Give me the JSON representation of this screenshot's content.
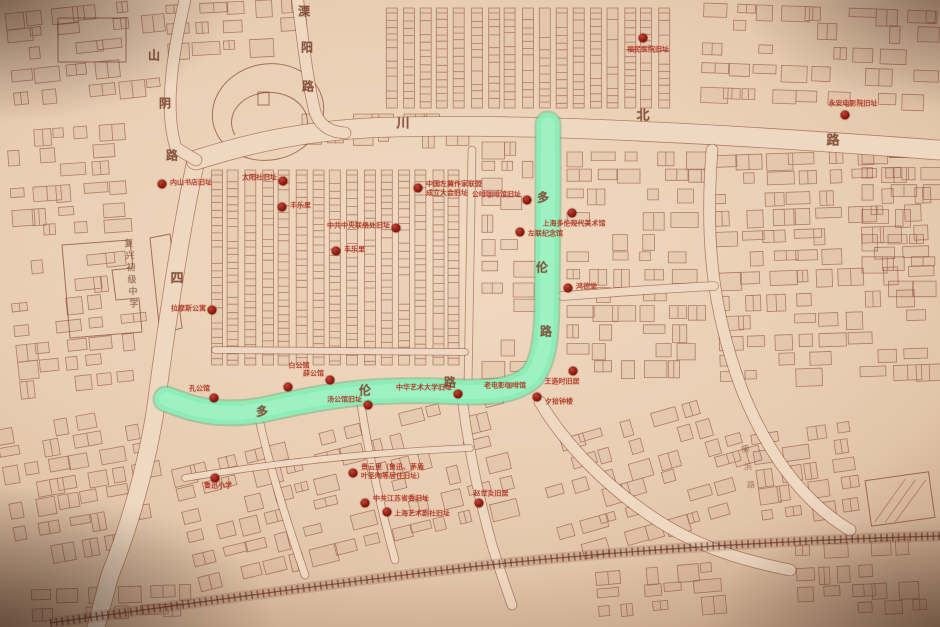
{
  "map": {
    "colors": {
      "paper": "#e8cdb2",
      "building_line": "#7b3a2b",
      "road_fill": "#eed8c2",
      "highlight_road": "#8feeb9",
      "marker_dot": "#8e1c10",
      "landmark_label": "#b23422",
      "street_text": "#7d4530"
    },
    "street_labels": [
      {
        "name": "shanyin-road",
        "text": "山阴路",
        "size": 12,
        "chars": [
          [
            "山",
            154,
            55
          ],
          [
            "阴",
            165,
            103
          ],
          [
            "路",
            172,
            155
          ]
        ]
      },
      {
        "name": "liyang-road",
        "text": "溧阳路",
        "size": 12,
        "chars": [
          [
            "溧",
            304,
            11
          ],
          [
            "阳",
            307,
            47
          ],
          [
            "路",
            308,
            86
          ]
        ]
      },
      {
        "name": "sichuan-north-road-top",
        "text": "川北路",
        "size": 13,
        "chars": [
          [
            "川",
            403,
            122
          ],
          [
            "北",
            643,
            114
          ],
          [
            "路",
            833,
            139
          ]
        ]
      },
      {
        "name": "sichuan-north-road-west",
        "text": "四",
        "size": 13,
        "chars": [
          [
            "四",
            177,
            277
          ]
        ]
      },
      {
        "name": "duolun-road-north-segment",
        "text": "多伦路",
        "size": 12,
        "chars": [
          [
            "多",
            543,
            197
          ],
          [
            "伦",
            542,
            267
          ],
          [
            "路",
            546,
            331
          ]
        ]
      },
      {
        "name": "duolun-road-west-segment",
        "text": "多伦路",
        "size": 12,
        "chars": [
          [
            "多",
            262,
            411
          ],
          [
            "伦",
            365,
            390
          ],
          [
            "路",
            450,
            382
          ]
        ]
      },
      {
        "name": "hengbang-road",
        "text": "横浜路",
        "size": 8,
        "faint": true,
        "chars": [
          [
            "横",
            745,
            449
          ],
          [
            "浜",
            748,
            467
          ],
          [
            "路",
            751,
            485
          ]
        ]
      },
      {
        "name": "fuxing-junior-high-school",
        "text": "复兴初级中学",
        "size": 9,
        "muted": true,
        "chars": [
          [
            "复",
            129,
            243
          ],
          [
            "兴",
            130,
            255
          ],
          [
            "初",
            131,
            267
          ],
          [
            "级",
            132,
            279
          ],
          [
            "中",
            133,
            291
          ],
          [
            "学",
            134,
            303
          ]
        ]
      }
    ],
    "landmarks": [
      {
        "label": "内山书店旧址",
        "x": 162,
        "y": 184,
        "lx": 170,
        "ly": 183,
        "align": "right"
      },
      {
        "label": "太阳社旧址",
        "x": 283,
        "y": 181,
        "lx": 277,
        "ly": 178,
        "align": "left"
      },
      {
        "label": "丰乐里",
        "x": 282,
        "y": 207,
        "lx": 290,
        "ly": 206,
        "align": "right"
      },
      {
        "label": "丰乐里",
        "x": 336,
        "y": 251,
        "lx": 344,
        "ly": 250,
        "align": "right"
      },
      {
        "label": "中共中央联络处旧址",
        "x": 396,
        "y": 228,
        "lx": 390,
        "ly": 226,
        "align": "left"
      },
      {
        "label": "中国左翼作家联盟\n成立大会旧址",
        "x": 418,
        "y": 188,
        "lx": 426,
        "ly": 189,
        "align": "right"
      },
      {
        "label": "公啡咖啡馆旧址",
        "x": 527,
        "y": 200,
        "lx": 521,
        "ly": 195,
        "align": "left"
      },
      {
        "label": "上海多伦现代美术馆",
        "x": 572,
        "y": 213,
        "lx": 574,
        "ly": 224,
        "align": "center"
      },
      {
        "label": "左联纪念馆",
        "x": 520,
        "y": 232,
        "lx": 528,
        "ly": 234,
        "align": "right"
      },
      {
        "label": "鸿德堂",
        "x": 568,
        "y": 288,
        "lx": 576,
        "ly": 287,
        "align": "right"
      },
      {
        "label": "福民医院旧址",
        "x": 643,
        "y": 38,
        "lx": 648,
        "ly": 50,
        "align": "center"
      },
      {
        "label": "永安电影院旧址",
        "x": 845,
        "y": 115,
        "lx": 853,
        "ly": 104,
        "align": "center"
      },
      {
        "label": "拉摩斯公寓",
        "x": 212,
        "y": 310,
        "lx": 206,
        "ly": 309,
        "align": "left"
      },
      {
        "label": "孔公馆",
        "x": 214,
        "y": 398,
        "lx": 210,
        "ly": 389,
        "align": "left"
      },
      {
        "label": "白公馆",
        "x": 288,
        "y": 387,
        "lx": 299,
        "ly": 366,
        "align": "center"
      },
      {
        "label": "薛公馆",
        "x": 330,
        "y": 380,
        "lx": 324,
        "ly": 374,
        "align": "left"
      },
      {
        "label": "汤公馆旧址",
        "x": 368,
        "y": 405,
        "lx": 362,
        "ly": 400,
        "align": "left"
      },
      {
        "label": "中华艺术大学旧址",
        "x": 458,
        "y": 394,
        "lx": 452,
        "ly": 388,
        "align": "left"
      },
      {
        "label": "老电影咖啡馆",
        "dot": false,
        "x": 0,
        "y": 0,
        "lx": 484,
        "ly": 386,
        "align": "right"
      },
      {
        "label": "夕拾钟楼",
        "x": 537,
        "y": 397,
        "lx": 545,
        "ly": 402,
        "align": "right"
      },
      {
        "label": "王造时旧居",
        "x": 573,
        "y": 371,
        "lx": 562,
        "ly": 382,
        "align": "center"
      },
      {
        "label": "景云里（鲁迅、茅盾\n叶圣陶等居住旧址）",
        "x": 353,
        "y": 473,
        "lx": 361,
        "ly": 472,
        "align": "right"
      },
      {
        "label": "中共江苏省委旧址",
        "x": 365,
        "y": 503,
        "lx": 373,
        "ly": 499,
        "align": "right"
      },
      {
        "label": "上海艺术剧社旧址",
        "x": 387,
        "y": 512,
        "lx": 394,
        "ly": 514,
        "align": "right"
      },
      {
        "label": "赵世炎旧居",
        "x": 479,
        "y": 503,
        "lx": 491,
        "ly": 494,
        "align": "center"
      },
      {
        "label": "鲁迅小学",
        "x": 215,
        "y": 478,
        "lx": 218,
        "ly": 486,
        "align": "center"
      }
    ]
  }
}
